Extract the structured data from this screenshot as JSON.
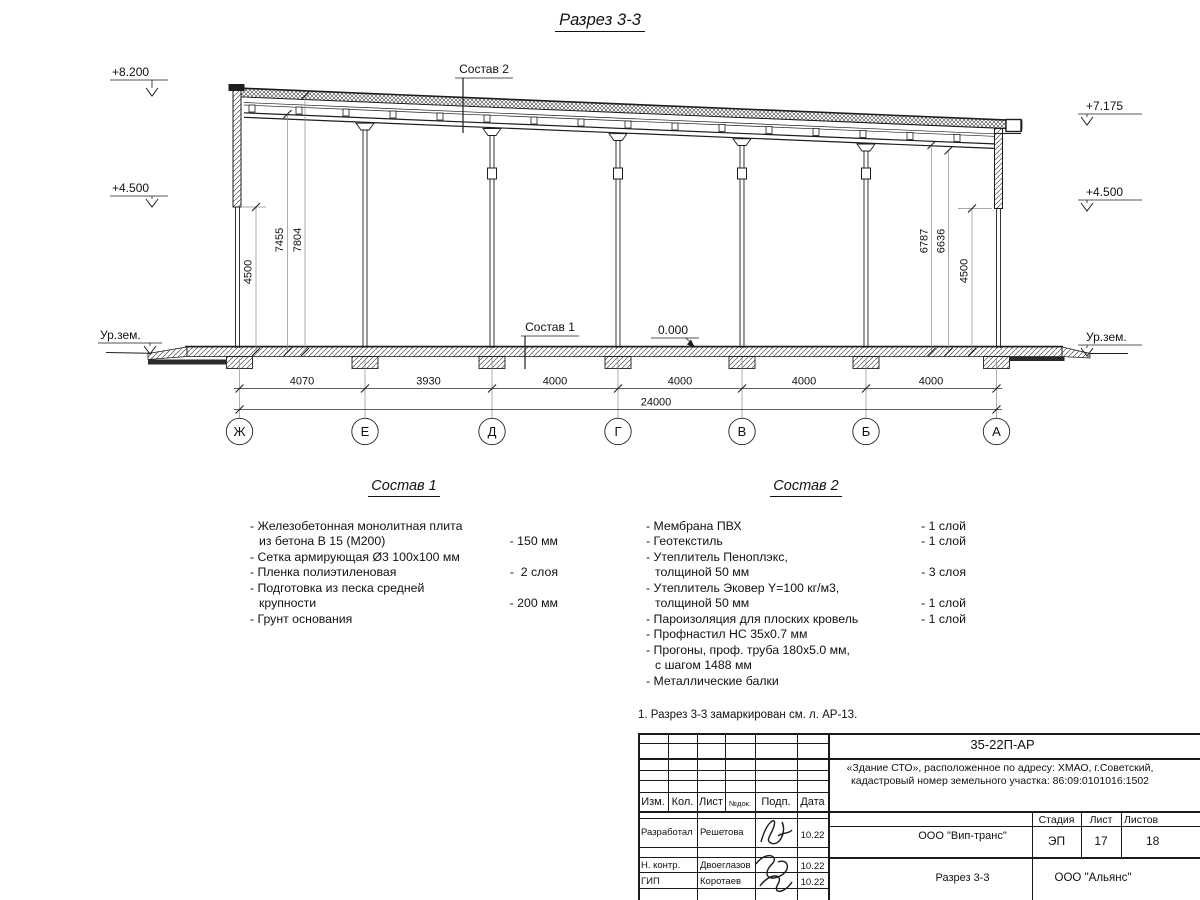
{
  "title": "Разрез 3-3",
  "drawing": {
    "elevations": {
      "e8200": "+8.200",
      "e4500l": "+4.500",
      "urzem_l": "Ур.зем.",
      "e7175": "+7.175",
      "e4500r": "+4.500",
      "urzem_r": "Ур.зем.",
      "zero": "0.000"
    },
    "sostav1_label": "Состав 1",
    "sostav2_label": "Состав 2",
    "axes": [
      "Ж",
      "Е",
      "Д",
      "Г",
      "В",
      "Б",
      "А"
    ],
    "dims_span": [
      "4070",
      "3930",
      "4000",
      "4000",
      "4000",
      "4000"
    ],
    "dim_total": "24000",
    "dims_left": [
      "4500",
      "7455",
      "7804"
    ],
    "dims_right": [
      "6787",
      "6636",
      "4500"
    ]
  },
  "sostav1": {
    "heading": "Состав 1",
    "items": [
      {
        "l1": "- Железобетонная  монолитная плита",
        "l2": "из бетона В 15 (М200)",
        "value": "- 150 мм"
      },
      {
        "l1": "- Сетка армирующая Ø3 100х100 мм"
      },
      {
        "l1": "- Пленка полиэтиленовая",
        "value": "-  2 слоя"
      },
      {
        "l1": "- Подготовка из песка средней",
        "l2": "крупности",
        "value": "- 200 мм"
      },
      {
        "l1": "- Грунт основания"
      }
    ]
  },
  "sostav2": {
    "heading": "Состав 2",
    "items": [
      {
        "l1": "- Мембрана ПВХ",
        "value": "- 1 слой"
      },
      {
        "l1": "- Геотекстиль",
        "value": "- 1 слой"
      },
      {
        "l1": "- Утеплитель Пеноплэкс,",
        "l2": "толщиной 50 мм",
        "value": "- 3 слоя"
      },
      {
        "l1": "- Утеплитель Эковер Y=100 кг/м3,",
        "l2": "толщиной 50 мм",
        "value": "- 1 слой"
      },
      {
        "l1": "- Пароизоляция для плоских кровель",
        "value": "- 1 слой"
      },
      {
        "l1": "- Профнастил НС 35х0.7 мм"
      },
      {
        "l1": "- Прогоны, проф. труба 180х5.0 мм,",
        "l2": "с шагом 1488 мм"
      },
      {
        "l1": "- Металлические балки"
      }
    ]
  },
  "note": "1. Разрез 3-3 замаркирован см. л. АР-13.",
  "titleblock": {
    "doc_number": "35-22П-АР",
    "project_line1": "«Здание СТО», расположенное по адресу: ХМАО, г.Советский,",
    "project_line2": "кадастровый номер земельного участка: 86:09:0101016:1502",
    "col_izm": "Изм.",
    "col_kol": "Кол.",
    "col_list": "Лист",
    "col_ndok": "№док.",
    "col_podp": "Подп.",
    "col_data": "Дата",
    "row1_role": "Разработал",
    "row1_name": "Решетова",
    "row1_date": "10.22",
    "row2_role": "Н. контр.",
    "row2_name": "Двоеглазов",
    "row2_date": "10.22",
    "row3_role": "ГИП",
    "row3_name": "Коротаев",
    "row3_date": "10.22",
    "contractor": "ООО \"Вип-транс\"",
    "stage_label": "Стадия",
    "sheet_label": "Лист",
    "sheets_label": "Листов",
    "stage": "ЭП",
    "sheet": "17",
    "sheets": "18",
    "drawing_name": "Разрез 3-3",
    "org": "ООО \"Альянс\""
  }
}
